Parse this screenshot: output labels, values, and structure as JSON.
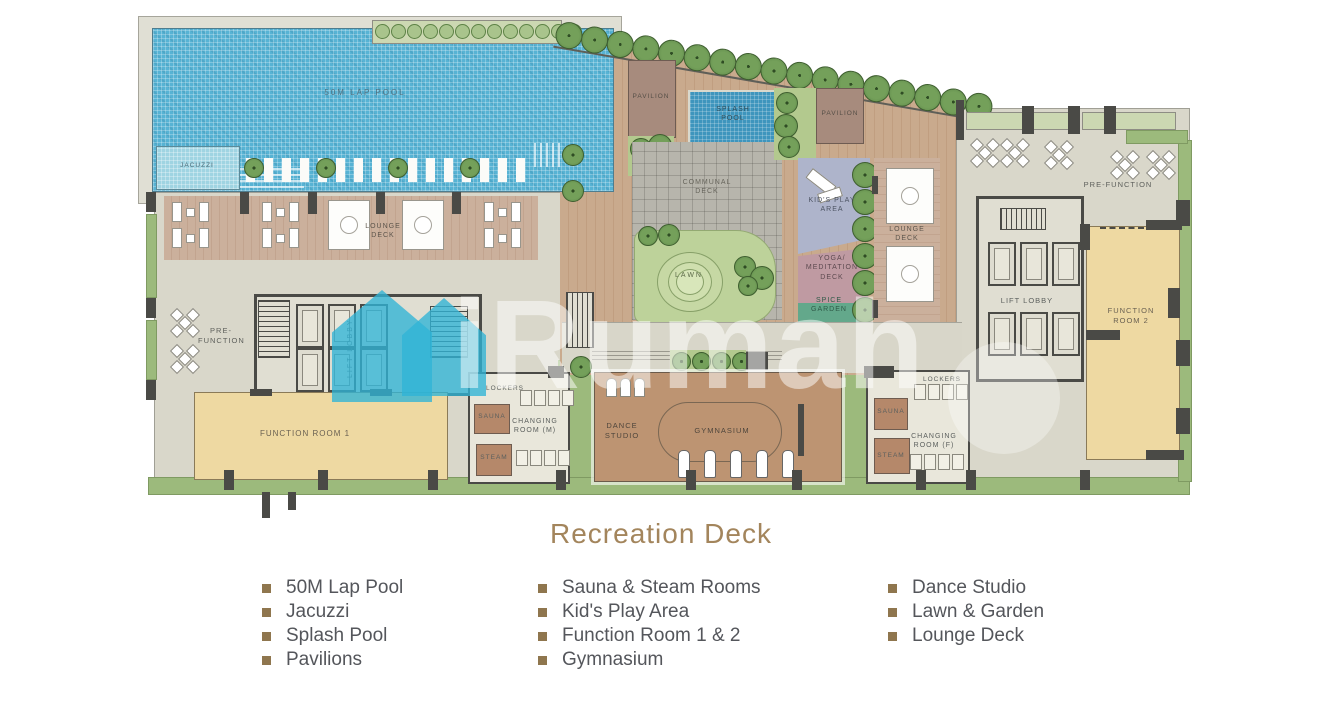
{
  "title": "Recreation Deck",
  "watermark": {
    "brand": "iRumah"
  },
  "colors": {
    "pool": "#57b3d4",
    "splash_pool": "#3e95bd",
    "jacuzzi": "#9fd4e2",
    "wood_deck": "#c8a98b",
    "communal_deck": "#b6b4ab",
    "lawn": "#bdd29a",
    "garden_green": "#9cba7c",
    "kids_play": "#aeb4cb",
    "yoga_deck": "#bf9aa2",
    "spice_garden": "#63a88b",
    "function_room": "#eed9a2",
    "lounge_deck": "#cbaf9b",
    "indoor_floor": "#d9d7ca",
    "wall": "#4a4a46",
    "tree": "#6e9b52",
    "watermark_teal": "#2fb3d6",
    "title_text": "#a3855c",
    "legend_text": "#54565b",
    "legend_bullet": "#8f764e"
  },
  "plan": {
    "labels": {
      "lap_pool": "50M LAP POOL",
      "jacuzzi": "JACUZZI",
      "pavilion_left": "PAVILION",
      "pavilion_right": "PAVILION",
      "splash_pool": "SPLASH POOL",
      "communal_deck": "COMMUNAL DECK",
      "lawn": "LAWN",
      "kids_play": "KID'S PLAY AREA",
      "yoga": "YOGA/ MEDITATION DECK",
      "spice": "SPICE GARDEN",
      "lounge_left": "LOUNGE DECK",
      "lounge_right": "LOUNGE DECK",
      "pre_function_left": "PRE-FUNCTION",
      "pre_function_right": "PRE-FUNCTION",
      "lift_lobby_left": "LIFT LOBBY",
      "lift_lobby_right": "LIFT LOBBY",
      "function_room_1": "FUNCTION ROOM 1",
      "function_room_2": "FUNCTION ROOM 2",
      "lockers_m": "LOCKERS",
      "lockers_f": "LOCKERS",
      "sauna_m": "SAUNA",
      "sauna_f": "SAUNA",
      "steam_m": "STEAM",
      "steam_f": "STEAM",
      "changing_m": "CHANGING ROOM (M)",
      "changing_f": "CHANGING ROOM (F)",
      "dance": "DANCE STUDIO",
      "gym": "GYMNASIUM"
    }
  },
  "legend": {
    "columns": [
      {
        "items": [
          "50M Lap Pool",
          "Jacuzzi",
          "Splash Pool",
          "Pavilions"
        ]
      },
      {
        "items": [
          "Sauna & Steam Rooms",
          "Kid's Play Area",
          "Function Room 1 & 2",
          "Gymnasium"
        ]
      },
      {
        "items": [
          "Dance Studio",
          "Lawn & Garden",
          "Lounge Deck"
        ]
      }
    ]
  }
}
